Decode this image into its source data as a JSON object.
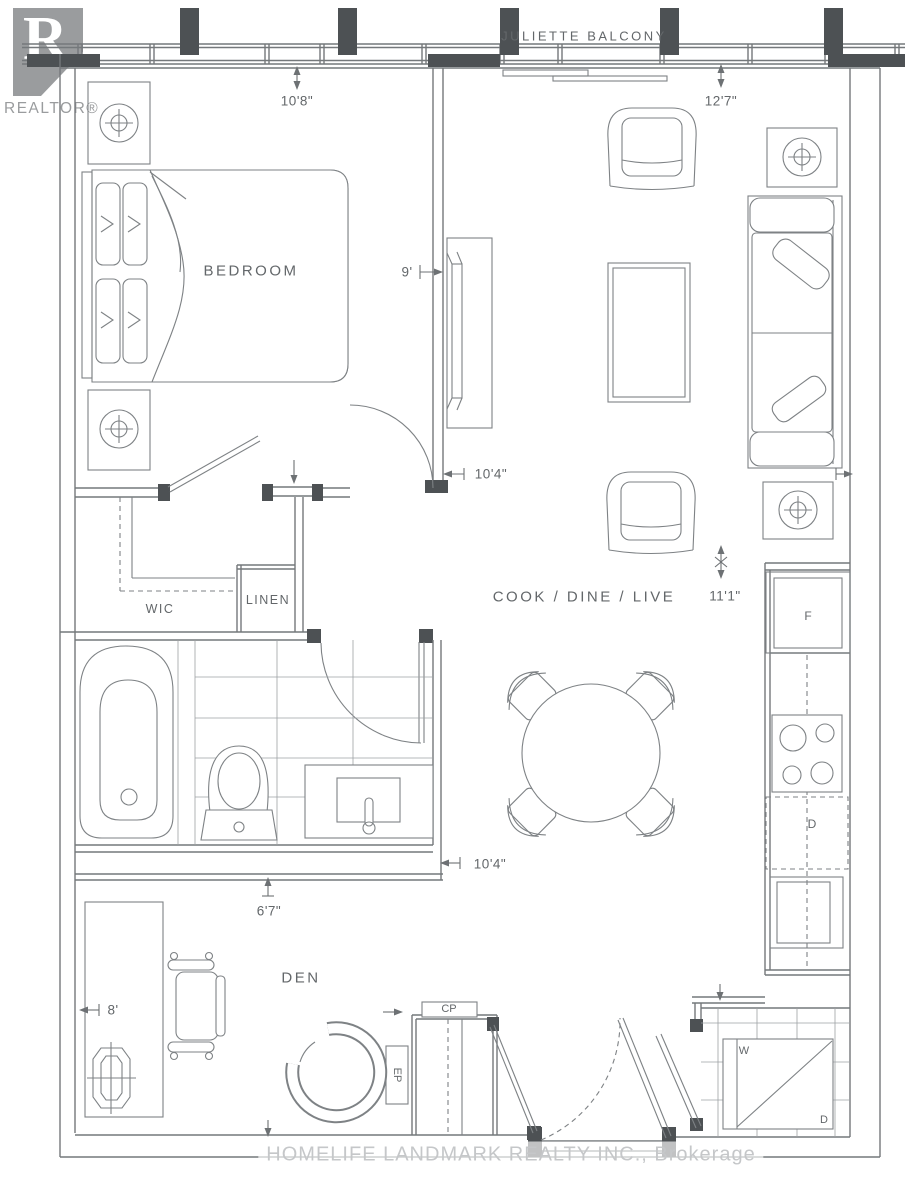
{
  "branding": {
    "realtor_logo_letter": "R",
    "realtor_logo_text": "REALTOR®",
    "brokerage_watermark": "HOMELIFE LANDMARK REALTY INC., Brokerage"
  },
  "rooms": {
    "balcony": "JULIETTE BALCONY",
    "bedroom": "BEDROOM",
    "wic": "WIC",
    "linen": "LINEN",
    "cook_dine_live": "COOK / DINE / LIVE",
    "den": "DEN"
  },
  "appliances": {
    "fridge": "F",
    "dishwasher": "D",
    "washer": "W",
    "dryer": "D",
    "cp_closet": "CP",
    "ep_panel": "EP"
  },
  "dimensions": {
    "bedroom_height": "10'8\"",
    "living_height": "12'7\"",
    "bedroom_width": "9'",
    "living_width_upper": "10'4\"",
    "living_length": "11'1\"",
    "living_width_lower": "10'4\"",
    "den_depth": "6'7\"",
    "den_width": "8'"
  },
  "colors": {
    "line": "#7e8285",
    "wall": "#74787b",
    "wall_dark": "#4d5154",
    "text": "#63676a",
    "watermark": "#c5c7c9",
    "logo_gray": "#9a9c9e",
    "background": "#ffffff"
  }
}
